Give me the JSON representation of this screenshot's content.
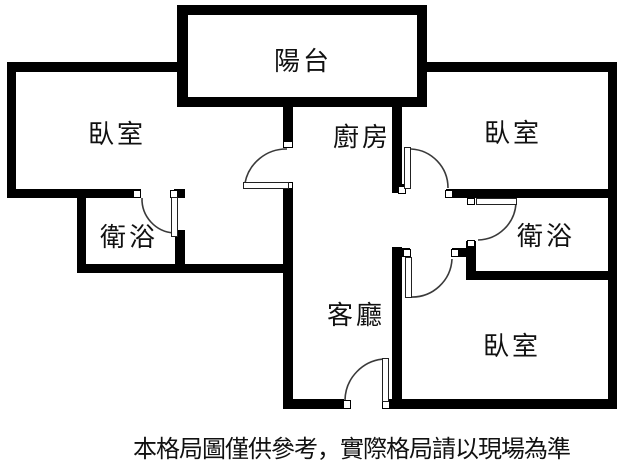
{
  "plan": {
    "type": "apartment-floor-plan",
    "rooms": [
      {
        "id": "balcony",
        "label": "陽台"
      },
      {
        "id": "bedroom-top-left",
        "label": "臥室"
      },
      {
        "id": "kitchen",
        "label": "廚房"
      },
      {
        "id": "bedroom-top-right",
        "label": "臥室"
      },
      {
        "id": "bathroom-left",
        "label": "衛浴"
      },
      {
        "id": "bathroom-right",
        "label": "衛浴"
      },
      {
        "id": "living-room",
        "label": "客廳"
      },
      {
        "id": "bedroom-bottom-right",
        "label": "臥室"
      }
    ],
    "disclaimer": "本格局圖僅供參考，實際格局請以現場為準",
    "colors": {
      "wall": "#000000",
      "background": "#ffffff",
      "door_line": "#3a3a3a",
      "text": "#111111"
    }
  }
}
